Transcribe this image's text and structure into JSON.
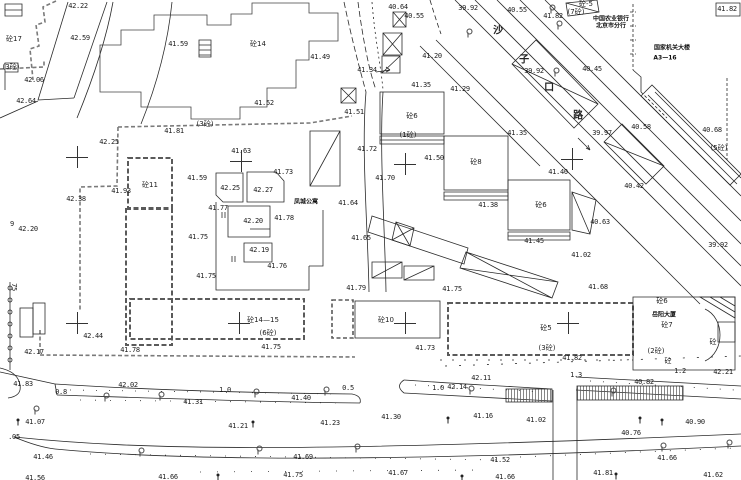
{
  "map_title": "topographic cadastral survey plan",
  "place_names": {
    "street": "沙子口路",
    "bank_line1": "中国农业银行",
    "bank_line2": "北京市分行",
    "gov_block_line1": "国家机关大楼",
    "gov_block_line2": "A3—16",
    "apartment": "凤城公寓",
    "tower": "岳阳大厦"
  },
  "labels": [
    {
      "t": "42.22",
      "x": 78,
      "y": 6,
      "c": "e"
    },
    {
      "t": "40.64",
      "x": 398,
      "y": 7,
      "c": "e"
    },
    {
      "t": "40.55",
      "x": 414,
      "y": 16,
      "c": "e"
    },
    {
      "t": "39.92",
      "x": 468,
      "y": 8,
      "c": "e"
    },
    {
      "t": "40.55",
      "x": 517,
      "y": 10,
      "c": "e"
    },
    {
      "t": "41.82",
      "x": 553,
      "y": 16,
      "c": "e"
    },
    {
      "t": "砼-5",
      "x": 586,
      "y": 4,
      "c": "b"
    },
    {
      "t": "(7砼)",
      "x": 576,
      "y": 12,
      "c": "b"
    },
    {
      "t": "中国农业银行",
      "x": 611,
      "y": 18,
      "c": "n2"
    },
    {
      "t": "北京市分行",
      "x": 611,
      "y": 25,
      "c": "n2"
    },
    {
      "t": "41.82",
      "x": 727,
      "y": 9,
      "c": "e"
    },
    {
      "t": "沙",
      "x": 498,
      "y": 29,
      "c": "s"
    },
    {
      "t": "子",
      "x": 524,
      "y": 58,
      "c": "s"
    },
    {
      "t": "口",
      "x": 549,
      "y": 86,
      "c": "s"
    },
    {
      "t": "路",
      "x": 578,
      "y": 114,
      "c": "s"
    },
    {
      "t": "39.92",
      "x": 534,
      "y": 71,
      "c": "e"
    },
    {
      "t": "40.45",
      "x": 592,
      "y": 69,
      "c": "e"
    },
    {
      "t": "国家机关大楼",
      "x": 672,
      "y": 47,
      "c": "n2"
    },
    {
      "t": "A3—16",
      "x": 665,
      "y": 58,
      "c": "n2"
    },
    {
      "t": "42.59",
      "x": 80,
      "y": 38,
      "c": "e"
    },
    {
      "t": "41.59",
      "x": 178,
      "y": 44,
      "c": "e"
    },
    {
      "t": "砼17",
      "x": 14,
      "y": 39,
      "c": "b"
    },
    {
      "t": "砼14",
      "x": 258,
      "y": 44,
      "c": "b"
    },
    {
      "t": "41.49",
      "x": 320,
      "y": 57,
      "c": "e"
    },
    {
      "t": "41.34",
      "x": 367,
      "y": 70,
      "c": "e"
    },
    {
      "t": "41.20",
      "x": 432,
      "y": 56,
      "c": "e"
    },
    {
      "t": "42.06",
      "x": 34,
      "y": 80,
      "c": "e"
    },
    {
      "t": "42.64",
      "x": 26,
      "y": 101,
      "c": "e"
    },
    {
      "t": "(3砼)",
      "x": 11,
      "y": 67,
      "c": "b"
    },
    {
      "t": "41.35",
      "x": 421,
      "y": 85,
      "c": "e"
    },
    {
      "t": "41.29",
      "x": 460,
      "y": 89,
      "c": "e"
    },
    {
      "t": "41.52",
      "x": 264,
      "y": 103,
      "c": "e"
    },
    {
      "t": "41.51",
      "x": 354,
      "y": 112,
      "c": "e"
    },
    {
      "t": "砼6",
      "x": 412,
      "y": 116,
      "c": "b"
    },
    {
      "t": "40.58",
      "x": 641,
      "y": 127,
      "c": "e"
    },
    {
      "t": "39.97",
      "x": 602,
      "y": 133,
      "c": "e"
    },
    {
      "t": "40.68",
      "x": 712,
      "y": 130,
      "c": "e"
    },
    {
      "t": "(5砼)",
      "x": 719,
      "y": 148,
      "c": "b"
    },
    {
      "t": "41.81",
      "x": 174,
      "y": 131,
      "c": "e"
    },
    {
      "t": "(3砼)",
      "x": 205,
      "y": 124,
      "c": "b"
    },
    {
      "t": "42.25",
      "x": 109,
      "y": 142,
      "c": "e"
    },
    {
      "t": "41.72",
      "x": 367,
      "y": 149,
      "c": "e"
    },
    {
      "t": "41.70",
      "x": 385,
      "y": 178,
      "c": "e"
    },
    {
      "t": "41.50",
      "x": 434,
      "y": 158,
      "c": "e"
    },
    {
      "t": "(1砼)",
      "x": 408,
      "y": 135,
      "c": "b"
    },
    {
      "t": "砼8",
      "x": 476,
      "y": 162,
      "c": "b"
    },
    {
      "t": "41.35",
      "x": 517,
      "y": 133,
      "c": "e"
    },
    {
      "t": "41.40",
      "x": 558,
      "y": 172,
      "c": "e"
    },
    {
      "t": "40.42",
      "x": 634,
      "y": 186,
      "c": "e"
    },
    {
      "t": "41.93",
      "x": 121,
      "y": 191,
      "c": "e"
    },
    {
      "t": "42.38",
      "x": 76,
      "y": 199,
      "c": "e"
    },
    {
      "t": "41.63",
      "x": 241,
      "y": 151,
      "c": "e"
    },
    {
      "t": "41.59",
      "x": 197,
      "y": 178,
      "c": "e"
    },
    {
      "t": "41.73",
      "x": 283,
      "y": 172,
      "c": "e"
    },
    {
      "t": "砼11",
      "x": 150,
      "y": 185,
      "c": "b"
    },
    {
      "t": "42.25",
      "x": 230,
      "y": 188,
      "c": "e"
    },
    {
      "t": "42.27",
      "x": 263,
      "y": 190,
      "c": "e"
    },
    {
      "t": "凤城公寓",
      "x": 306,
      "y": 201,
      "c": "n2"
    },
    {
      "t": "41.64",
      "x": 348,
      "y": 203,
      "c": "e"
    },
    {
      "t": "41.77",
      "x": 218,
      "y": 208,
      "c": "e"
    },
    {
      "t": "41.78",
      "x": 284,
      "y": 218,
      "c": "e"
    },
    {
      "t": "42.20",
      "x": 253,
      "y": 221,
      "c": "e"
    },
    {
      "t": "41.38",
      "x": 488,
      "y": 205,
      "c": "e"
    },
    {
      "t": "砼6",
      "x": 541,
      "y": 205,
      "c": "b"
    },
    {
      "t": "40.63",
      "x": 600,
      "y": 222,
      "c": "e"
    },
    {
      "t": "9",
      "x": 12,
      "y": 224,
      "c": "e"
    },
    {
      "t": "42.20",
      "x": 28,
      "y": 229,
      "c": "e"
    },
    {
      "t": "41.75",
      "x": 198,
      "y": 237,
      "c": "e"
    },
    {
      "t": "42.19",
      "x": 259,
      "y": 250,
      "c": "e"
    },
    {
      "t": "41.65",
      "x": 361,
      "y": 238,
      "c": "e"
    },
    {
      "t": "41.45",
      "x": 534,
      "y": 241,
      "c": "e"
    },
    {
      "t": "39.92",
      "x": 718,
      "y": 245,
      "c": "e"
    },
    {
      "t": "41.76",
      "x": 277,
      "y": 266,
      "c": "e"
    },
    {
      "t": "41.75",
      "x": 206,
      "y": 276,
      "c": "e"
    },
    {
      "t": "41.02",
      "x": 581,
      "y": 255,
      "c": "e"
    },
    {
      "t": "75",
      "x": 14,
      "y": 287,
      "c": "v"
    },
    {
      "t": "41.79",
      "x": 356,
      "y": 288,
      "c": "e"
    },
    {
      "t": "41.75",
      "x": 452,
      "y": 289,
      "c": "e"
    },
    {
      "t": "41.68",
      "x": 598,
      "y": 287,
      "c": "e"
    },
    {
      "t": "砼6",
      "x": 662,
      "y": 301,
      "c": "b"
    },
    {
      "t": "岳阳大厦",
      "x": 664,
      "y": 314,
      "c": "n2"
    },
    {
      "t": "砼7",
      "x": 667,
      "y": 325,
      "c": "b"
    },
    {
      "t": "42.17",
      "x": 34,
      "y": 352,
      "c": "e"
    },
    {
      "t": "42.44",
      "x": 93,
      "y": 336,
      "c": "e"
    },
    {
      "t": "41.78",
      "x": 130,
      "y": 350,
      "c": "e"
    },
    {
      "t": "砼14—15",
      "x": 263,
      "y": 320,
      "c": "b"
    },
    {
      "t": "(6砼)",
      "x": 268,
      "y": 333,
      "c": "b"
    },
    {
      "t": "41.75",
      "x": 271,
      "y": 347,
      "c": "e"
    },
    {
      "t": "砼10",
      "x": 386,
      "y": 320,
      "c": "b"
    },
    {
      "t": "41.73",
      "x": 425,
      "y": 348,
      "c": "e"
    },
    {
      "t": "砼5",
      "x": 546,
      "y": 328,
      "c": "b"
    },
    {
      "t": "(3砼)",
      "x": 547,
      "y": 348,
      "c": "b"
    },
    {
      "t": "41.82",
      "x": 572,
      "y": 358,
      "c": "e"
    },
    {
      "t": "(2砼)",
      "x": 656,
      "y": 351,
      "c": "b"
    },
    {
      "t": "砼",
      "x": 668,
      "y": 361,
      "c": "b"
    },
    {
      "t": "砼",
      "x": 713,
      "y": 342,
      "c": "b"
    },
    {
      "t": "42.21",
      "x": 723,
      "y": 372,
      "c": "e"
    },
    {
      "t": "1.2",
      "x": 680,
      "y": 371,
      "c": "d"
    },
    {
      "t": "1.3",
      "x": 576,
      "y": 375,
      "c": "d"
    },
    {
      "t": "40.82",
      "x": 644,
      "y": 382,
      "c": "e"
    },
    {
      "t": "41.83",
      "x": 23,
      "y": 384,
      "c": "e"
    },
    {
      "t": "42.02",
      "x": 128,
      "y": 385,
      "c": "e"
    },
    {
      "t": "0.8",
      "x": 61,
      "y": 392,
      "c": "d"
    },
    {
      "t": "1.0",
      "x": 225,
      "y": 390,
      "c": "d"
    },
    {
      "t": "41.31",
      "x": 193,
      "y": 402,
      "c": "e"
    },
    {
      "t": "0.5",
      "x": 348,
      "y": 388,
      "c": "d"
    },
    {
      "t": "1.0",
      "x": 438,
      "y": 388,
      "c": "d"
    },
    {
      "t": "42.14",
      "x": 457,
      "y": 387,
      "c": "e"
    },
    {
      "t": "42.11",
      "x": 481,
      "y": 378,
      "c": "e"
    },
    {
      "t": "41.40",
      "x": 301,
      "y": 398,
      "c": "e"
    },
    {
      "t": "41.30",
      "x": 391,
      "y": 417,
      "c": "e"
    },
    {
      "t": "41.16",
      "x": 483,
      "y": 416,
      "c": "e"
    },
    {
      "t": "41.07",
      "x": 35,
      "y": 422,
      "c": "e"
    },
    {
      "t": "41.21",
      "x": 238,
      "y": 426,
      "c": "e"
    },
    {
      "t": "41.23",
      "x": 330,
      "y": 423,
      "c": "e"
    },
    {
      "t": ".05",
      "x": 14,
      "y": 437,
      "c": "e"
    },
    {
      "t": "41.46",
      "x": 43,
      "y": 457,
      "c": "e"
    },
    {
      "t": "41.69",
      "x": 303,
      "y": 457,
      "c": "e"
    },
    {
      "t": "41.02",
      "x": 536,
      "y": 420,
      "c": "e"
    },
    {
      "t": "40.76",
      "x": 631,
      "y": 433,
      "c": "e"
    },
    {
      "t": "40.90",
      "x": 695,
      "y": 422,
      "c": "e"
    },
    {
      "t": "41.52",
      "x": 500,
      "y": 460,
      "c": "e"
    },
    {
      "t": "41.66",
      "x": 667,
      "y": 458,
      "c": "e"
    },
    {
      "t": "41.56",
      "x": 35,
      "y": 478,
      "c": "e"
    },
    {
      "t": "41.66",
      "x": 168,
      "y": 477,
      "c": "e"
    },
    {
      "t": "41.75",
      "x": 293,
      "y": 475,
      "c": "e"
    },
    {
      "t": "41.67",
      "x": 398,
      "y": 473,
      "c": "e"
    },
    {
      "t": "41.66",
      "x": 505,
      "y": 477,
      "c": "e"
    },
    {
      "t": "41.81",
      "x": 603,
      "y": 473,
      "c": "e"
    },
    {
      "t": "41.62",
      "x": 713,
      "y": 475,
      "c": "e"
    }
  ],
  "symbols": {
    "crosses": [
      [
        77,
        157
      ],
      [
        241,
        161
      ],
      [
        77,
        323
      ],
      [
        239,
        323
      ],
      [
        405,
        323
      ],
      [
        568,
        323
      ],
      [
        572,
        159
      ],
      [
        405,
        164
      ]
    ],
    "trees": [
      [
        105,
        397
      ],
      [
        160,
        396
      ],
      [
        255,
        393
      ],
      [
        325,
        391
      ],
      [
        470,
        390
      ],
      [
        612,
        392
      ],
      [
        140,
        452
      ],
      [
        258,
        450
      ],
      [
        356,
        448
      ],
      [
        662,
        447
      ],
      [
        728,
        444
      ],
      [
        35,
        410
      ],
      [
        551,
        9
      ],
      [
        558,
        25
      ],
      [
        555,
        72
      ],
      [
        468,
        33
      ]
    ],
    "poles": [
      [
        18,
        422
      ],
      [
        253,
        424
      ],
      [
        448,
        420
      ],
      [
        640,
        420
      ],
      [
        662,
        422
      ],
      [
        218,
        477
      ],
      [
        462,
        478
      ],
      [
        616,
        476
      ]
    ]
  },
  "colors": {
    "line": "#2a2a2a",
    "fence": "#7a7a7a",
    "text": "#1c1c1c",
    "background": "#ffffff"
  }
}
